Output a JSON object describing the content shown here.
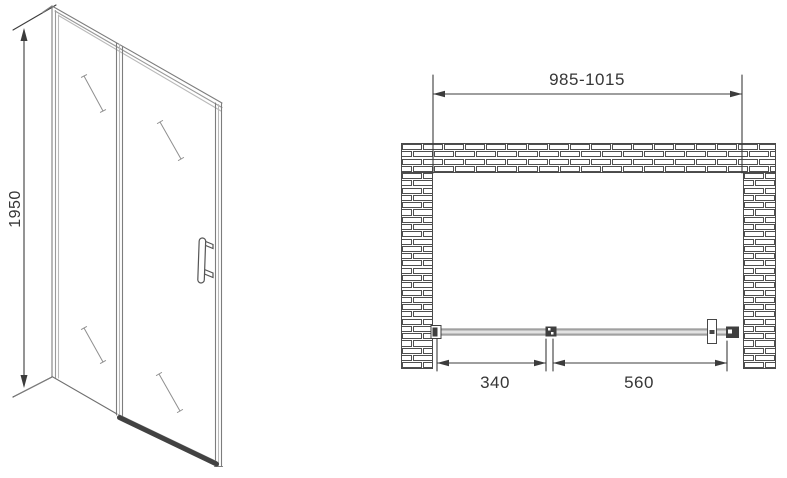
{
  "front_view": {
    "height_label": "1950"
  },
  "plan_view": {
    "opening_width_label": "985-1015",
    "fixed_section_label": "340",
    "door_section_label": "560"
  },
  "icons": {
    "door_handle": "d-shaped-pull-handle",
    "glass_shine": "diagonal-glass-reflection-mark",
    "brick_wall": "brick-hatch-pattern",
    "dimension_arrow": "filled-triangle-arrowhead"
  },
  "colors": {
    "dimension_line": "#3c3c3c",
    "frame_line": "#8a8a8a",
    "door_band_fill": "#c2c2c2",
    "wall_mortar_line": "#4a4a4a",
    "background": "#ffffff"
  }
}
